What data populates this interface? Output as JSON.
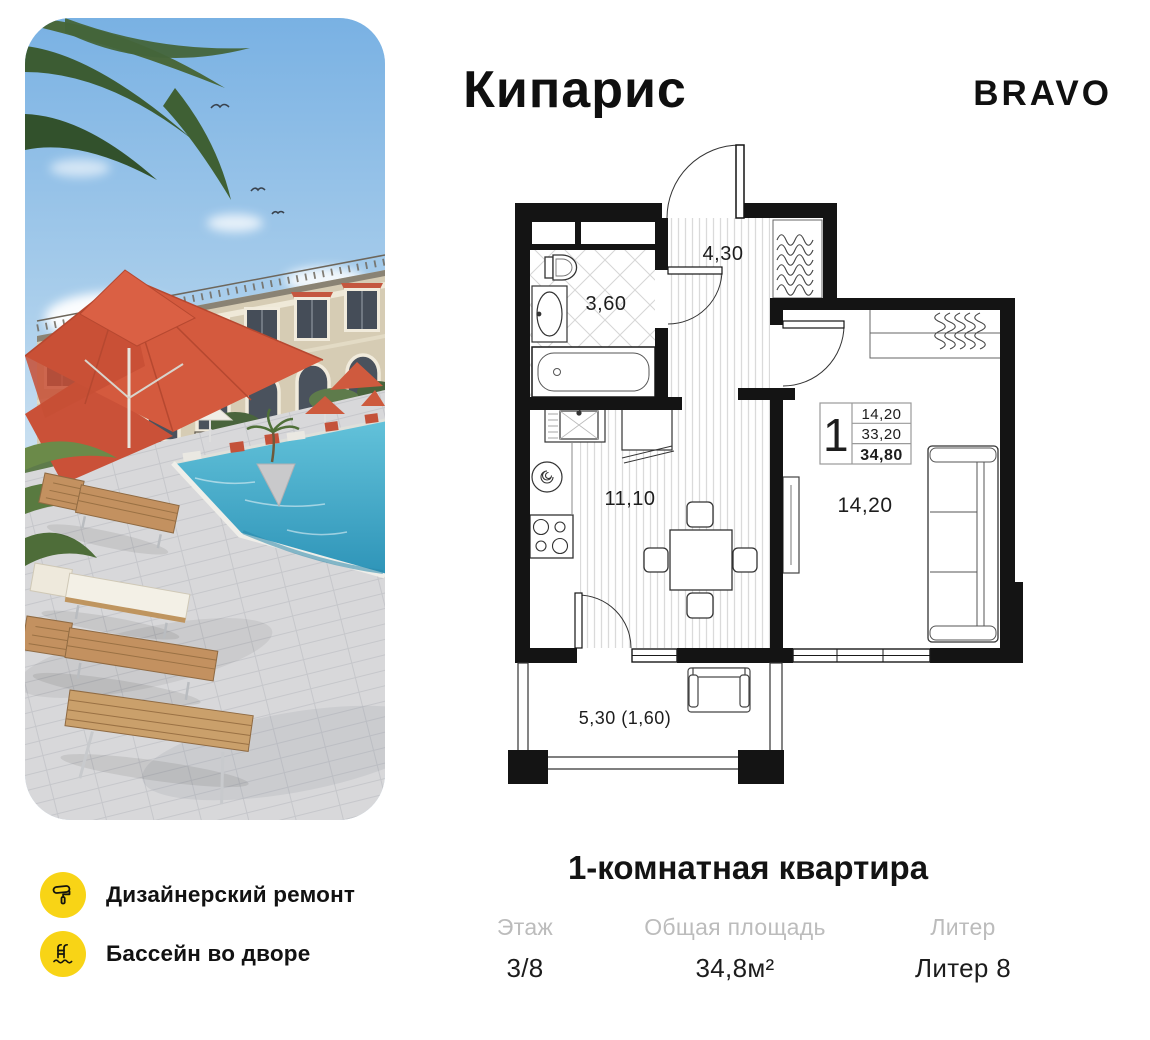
{
  "header": {
    "project_title": "Кипарис",
    "brand": "BRAVO"
  },
  "floor_plan": {
    "labels": {
      "hallway": "4,30",
      "bathroom": "3,60",
      "kitchen": "11,10",
      "room": "14,20",
      "balcony": "5,30 (1,60)"
    },
    "info_box": {
      "rooms": "1",
      "row1": "14,20",
      "row2": "33,20",
      "row3": "34,80"
    }
  },
  "summary": {
    "title": "1-комнатная квартира",
    "stats": [
      {
        "label": "Этаж",
        "value": "3/8"
      },
      {
        "label": "Общая площадь",
        "value": "34,8м²"
      },
      {
        "label": "Литер",
        "value": "Литер 8"
      }
    ]
  },
  "features": [
    {
      "icon": "paint-roller-icon",
      "label": "Дизайнерский ремонт"
    },
    {
      "icon": "pool-ladder-icon",
      "label": "Бассейн во дворе"
    }
  ],
  "colors": {
    "feature_yellow": "#F8D416",
    "umbrella_red": "#D2573C",
    "pool_water": "#4AAFCB",
    "stat_label_gray": "#BCBCBC",
    "plan_line_black": "#141414"
  }
}
